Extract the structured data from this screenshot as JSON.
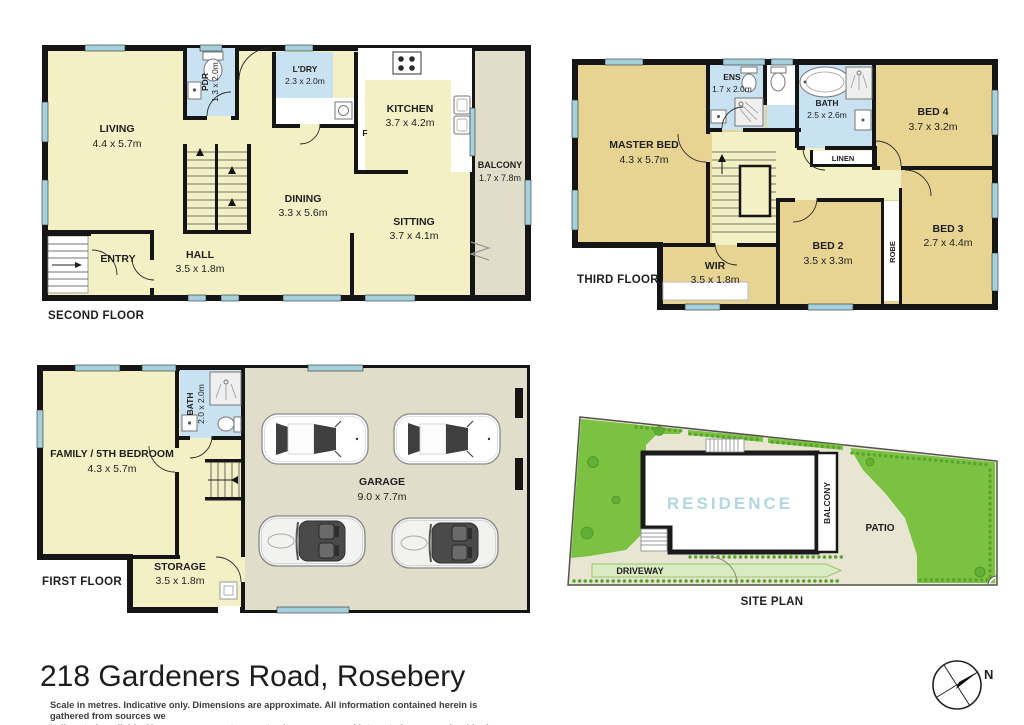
{
  "page": {
    "title": "218 Gardeners Road, Rosebery",
    "disclaimer_line1": "Scale in metres. Indicative only. Dimensions are approximate. All information contained herein is gathered from sources we",
    "disclaimer_line2": "believe to be reliable. However we cannot guarantee its accuracy and interested persons should rely on their own enquries.",
    "compass_north": "N"
  },
  "floors": {
    "second": {
      "label": "SECOND FLOOR",
      "living_name": "LIVING",
      "living_dims": "4.4 x 5.7m",
      "pdr_name": "PDR",
      "pdr_dims": "1.3 x 2.0m",
      "ldry_name": "L'DRY",
      "ldry_dims": "2.3 x 2.0m",
      "kitchen_name": "KITCHEN",
      "kitchen_dims": "3.7 x 4.2m",
      "fridge": "F",
      "balcony_name": "BALCONY",
      "balcony_dims": "1.7 x 7.8m",
      "dining_name": "DINING",
      "dining_dims": "3.3 x 5.6m",
      "sitting_name": "SITTING",
      "sitting_dims": "3.7 x 4.1m",
      "entry_name": "ENTRY",
      "hall_name": "HALL",
      "hall_dims": "3.5 x 1.8m"
    },
    "third": {
      "label": "THIRD FLOOR",
      "master_name": "MASTER BED",
      "master_dims": "4.3 x 5.7m",
      "ens_name": "ENS",
      "ens_dims": "1.7 x 2.0m",
      "bath_name": "BATH",
      "bath_dims": "2.5 x 2.6m",
      "bed4_name": "BED 4",
      "bed4_dims": "3.7 x 3.2m",
      "linen_name": "LINEN",
      "bed2_name": "BED 2",
      "bed2_dims": "3.5 x 3.3m",
      "robe_name": "ROBE",
      "bed3_name": "BED 3",
      "bed3_dims": "2.7 x 4.4m",
      "wir_name": "WIR",
      "wir_dims": "3.5 x 1.8m"
    },
    "first": {
      "label": "FIRST FLOOR",
      "family_name": "FAMILY / 5TH BEDROOM",
      "family_dims": "4.3 x 5.7m",
      "bath_name": "BATH",
      "bath_dims": "2.0 x 2.0m",
      "garage_name": "GARAGE",
      "garage_dims": "9.0 x 7.7m",
      "storage_name": "STORAGE",
      "storage_dims": "3.5 x 1.8m"
    }
  },
  "site": {
    "label": "SITE PLAN",
    "residence": "RESIDENCE",
    "balcony": "BALCONY",
    "patio": "PATIO",
    "driveway": "DRIVEWAY"
  },
  "colors": {
    "room_yellow": "#F4F0C5",
    "bedroom_tan": "#E7D493",
    "bath_blue": "#C9E2F2",
    "window_blue": "#A5D1DC",
    "garage_beige": "#E0DECA",
    "wall_black": "#151515",
    "lawn_green": "#7CC242",
    "site_beige": "#E8E6D3",
    "driveway_green": "#D9ECC1",
    "residence_text": "#AFD8E3"
  }
}
